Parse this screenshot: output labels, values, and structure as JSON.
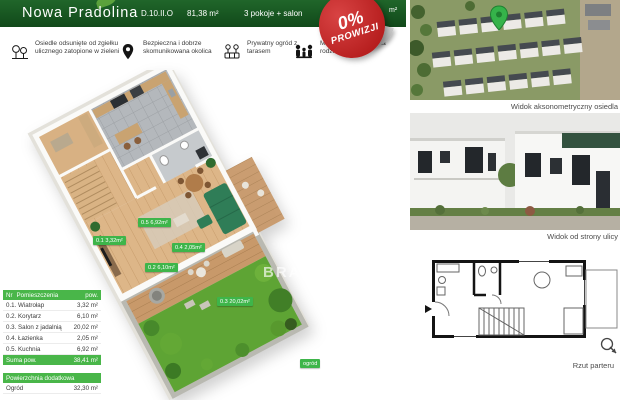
{
  "header": {
    "project_name": "Nowa Pradolina",
    "unit_id": "D.10.II.O",
    "area": "81,38 m²",
    "rooms": "3 pokoje + salon",
    "partial_start": "P",
    "partial_end": "m²"
  },
  "badge": {
    "line1": "0%",
    "line2": "PROWIZJI"
  },
  "features": [
    {
      "icon": "trees-icon",
      "text": "Osiedle odsunięte od zgiełku ulicznego zatopione w zieleni"
    },
    {
      "icon": "map-pin-icon",
      "text": "Bezpieczna i dobrze skomunikowana okolica"
    },
    {
      "icon": "garden-fence-icon",
      "text": "Prywatny ogród z tarasem"
    },
    {
      "icon": "family-icon",
      "text": "Mieszkanie idealne dla rodzin z dziećmi"
    }
  ],
  "plan3d": {
    "watermark": "BRAS",
    "labels": [
      "0.1  3,32m²",
      "0.2  6,10m²",
      "0.3  20,02m²",
      "0.4  2,05m²",
      "0.5  6,92m²",
      "ogród"
    ]
  },
  "rooms_table": {
    "headers": {
      "nr": "Nr",
      "name": "Pomieszczenia",
      "area": "pow."
    },
    "rows": [
      {
        "name": "0.1. Wiatrołap",
        "area": "3,32 m²"
      },
      {
        "name": "0.2. Korytarz",
        "area": "6,10 m²"
      },
      {
        "name": "0.3. Salon z jadalnią",
        "area": "20,02 m²"
      },
      {
        "name": "0.4. Łazienka",
        "area": "2,05 m²"
      },
      {
        "name": "0.5. Kuchnia",
        "area": "6,92 m²"
      }
    ],
    "sum_label": "Suma pow.",
    "sum_value": "38,41 m²"
  },
  "extra_table": {
    "header": "Powierzchnia dodatkowa",
    "rows": [
      {
        "name": "Ogród",
        "area": "32,30 m²"
      }
    ]
  },
  "gallery": {
    "caption_axonometric": "Widok aksonometryczny osiedla",
    "caption_street": "Widok od strony ulicy",
    "caption_plan": "Rzut parteru"
  },
  "colors": {
    "header_green": "#174f1a",
    "accent_green": "#3eb54a",
    "badge_red": "#b51d1d"
  }
}
